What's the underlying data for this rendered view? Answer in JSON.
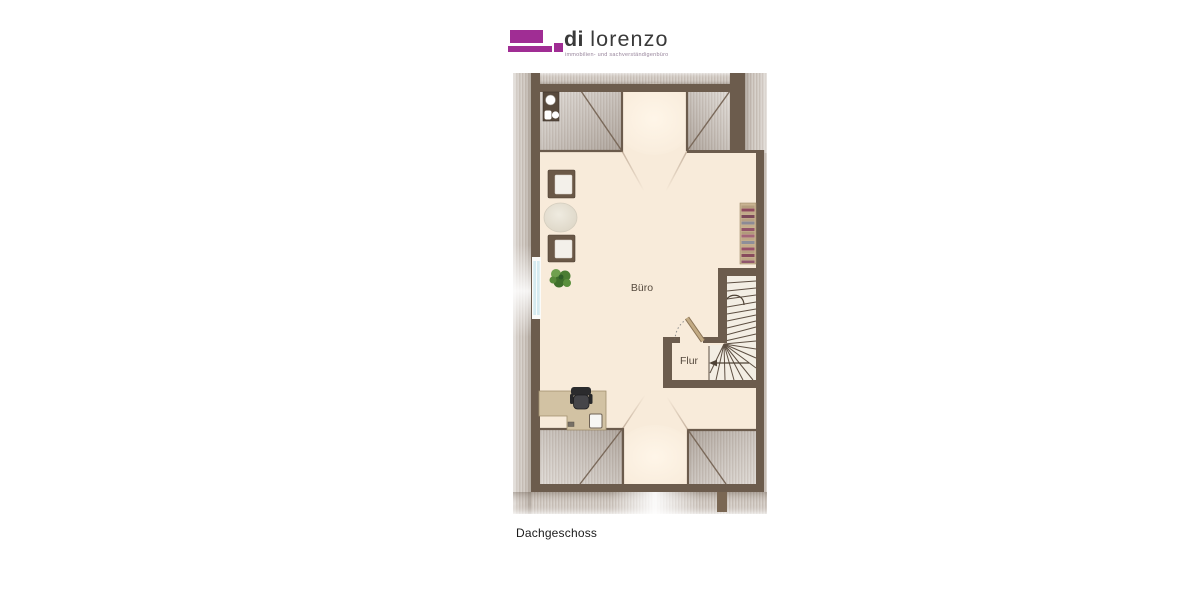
{
  "logo": {
    "brand_primary": "di",
    "brand_secondary": "lorenzo",
    "tagline": "immobilien- und sachverständigenbüro",
    "brand_color": "#a02d94"
  },
  "plan": {
    "caption": "Dachgeschoss",
    "rooms": [
      {
        "label": "Büro"
      },
      {
        "label": "Flur"
      }
    ],
    "palette": {
      "wall": "#6c5c4d",
      "floor": "#f8ebda",
      "roof_texture": "#d6d0ca",
      "window": "#d6ebf0",
      "desk": "#d2c2a3",
      "bookshelf": "#c9b392",
      "plant": "#4b7d33",
      "stair_lines": "#5d4f42",
      "chair": "#3a3a3d"
    }
  }
}
